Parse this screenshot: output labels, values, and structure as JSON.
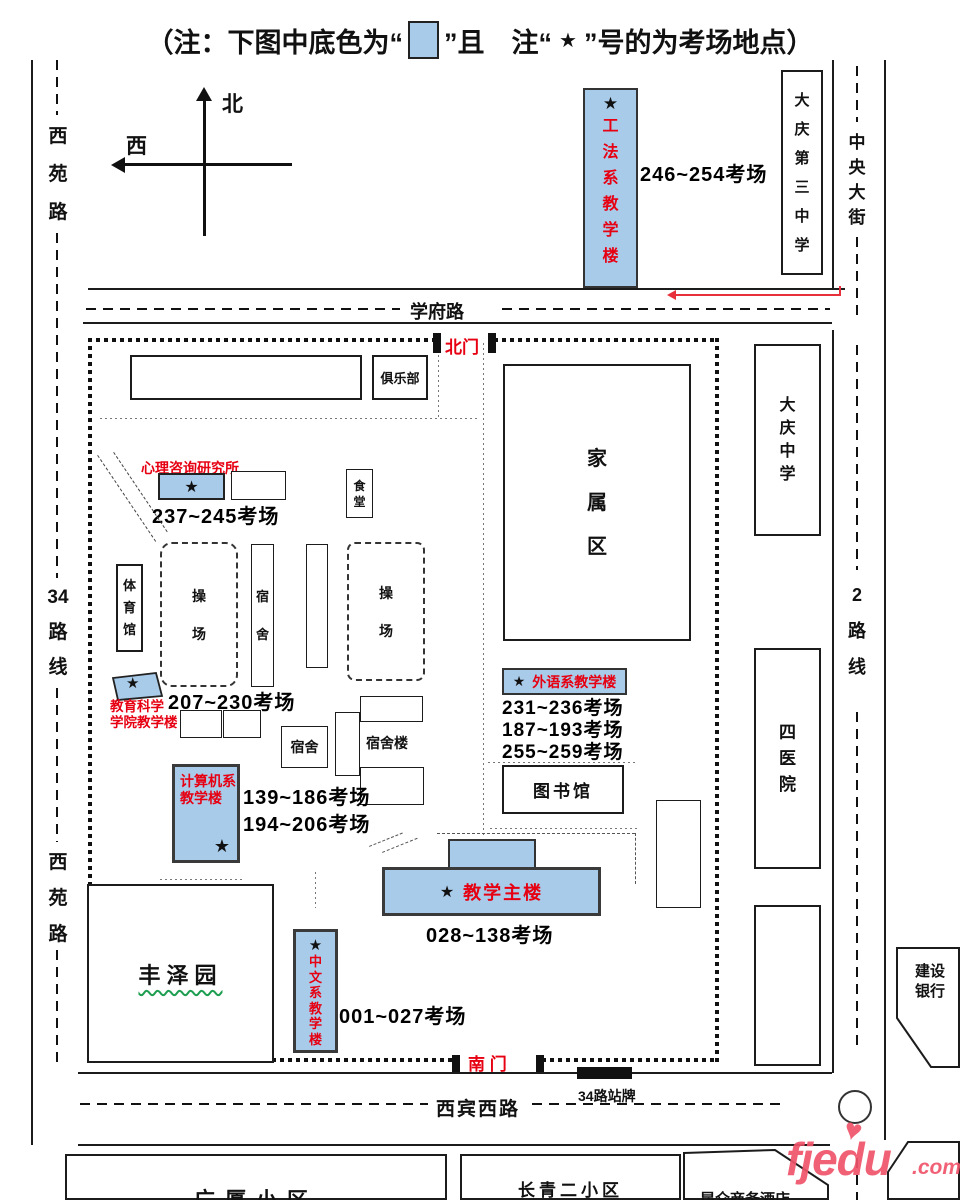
{
  "sym": {
    "star": "★",
    "heart": "♥"
  },
  "note": {
    "prefix": "（注：下图中底色为“",
    "mid": "”且　注“",
    "star": "★",
    "suffix": "”号的为考场地点）"
  },
  "compass": {
    "north": "北",
    "west": "西"
  },
  "roads": {
    "xiyuan_top": "西\n苑\n路",
    "line34": "34\n路\n线",
    "xiyuan_bottom": "西\n苑\n路",
    "xuefu": "学府路",
    "zhongyang": "中\n央\n大\n街",
    "line2": "2\n路\n线",
    "xibin": "西宾西路",
    "bus_stop_sign": "34路站牌"
  },
  "gates": {
    "north": "北门",
    "south": "南 门"
  },
  "exam": {
    "gongfa": {
      "name": "工\n法\n系\n教\n学\n楼",
      "rooms": "246~254考场"
    },
    "xinli": {
      "name": "心理咨询研究所",
      "rooms": "237~245考场"
    },
    "jiaoyu": {
      "name": "教育科学\n学院教学楼",
      "rooms": "207~230考场"
    },
    "waiyu": {
      "name": "外语系教学楼",
      "rooms": "231~236考场\n187~193考场\n255~259考场"
    },
    "jisuanji": {
      "name": "计算机系\n教学楼",
      "rooms": "139~186考场\n194~206考场"
    },
    "zhulou": {
      "name": "教学主楼",
      "rooms": "028~138考场"
    },
    "zhongwen": {
      "name": "中\n文\n系\n教\n学\n楼",
      "rooms": "001~027考场"
    }
  },
  "places": {
    "julebu": "俱乐部",
    "shitang": "食\n堂",
    "tiyuguan": "体\n育\n馆",
    "caochang1": "操\n场",
    "sushe1": "宿\n舍",
    "caochang2": "操\n场",
    "sushe2": "宿舍",
    "sushelou": "宿舍楼",
    "tushuguan": "图书馆",
    "jiashuqu": "家\n属\n区",
    "fengzeyuan": "丰泽园",
    "daqing_no3": "大\n庆\n第\n三\n中\n学",
    "daqing_zhongxue": "大\n庆\n中\n学",
    "siyiyuan": "四\n医\n院",
    "jianshe_bank": "建设\n银行",
    "guangsha": "广厦小区",
    "changqing": "长青二小区",
    "kunlun": "昆仑商务酒店"
  },
  "watermark": {
    "brand": "fjedu",
    "tld": ".com"
  },
  "colors": {
    "exam_blue": "#A9CBEA",
    "name_red": "#E60012",
    "watermark_pink": "#F0546A",
    "underline_green": "#1E9E50"
  }
}
